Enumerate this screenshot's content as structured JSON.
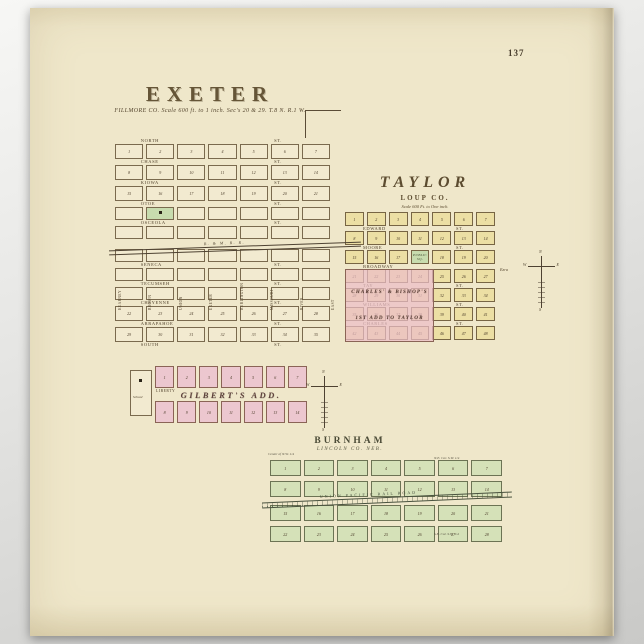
{
  "page": {
    "number": "137"
  },
  "compass": {
    "n": "N",
    "e": "E",
    "s": "S",
    "w": "W"
  },
  "exeter": {
    "title": "EXETER",
    "subtitle": "FILLMORE CO. Scale 600 ft. to 1 inch. Sec's 20 & 29. T.8 N. R.1 W.",
    "railroad": "B. & M. R. R.",
    "school": "School",
    "liberty": "LIBERTY",
    "avenues": [
      "KEARNEY",
      "BROWN",
      "UNION",
      "EXETER",
      "BURLINGTON",
      "MISSOURI",
      "RIVER",
      "EAST"
    ],
    "plat": {
      "rows": [
        {
          "street": {
            "n": "NORTH",
            "s": "ST."
          }
        },
        {
          "kind": "plain",
          "cells": [
            {
              "n": "1"
            },
            {
              "n": "2"
            },
            {
              "n": "3"
            },
            {
              "n": "4"
            },
            {
              "n": "5"
            },
            {
              "n": "6"
            },
            {
              "n": "7"
            }
          ]
        },
        {
          "street": {
            "n": "CHASE",
            "s": "ST."
          }
        },
        {
          "kind": "plain",
          "cells": [
            {
              "n": "8"
            },
            {
              "n": "9"
            },
            {
              "n": "10"
            },
            {
              "n": "11"
            },
            {
              "n": "12"
            },
            {
              "n": "13"
            },
            {
              "n": "14"
            }
          ]
        },
        {
          "street": {
            "n": "KIOWA",
            "s": "ST."
          }
        },
        {
          "kind": "plain",
          "cells": [
            {
              "n": "15"
            },
            {
              "n": "16"
            },
            {
              "n": "17"
            },
            {
              "n": "18"
            },
            {
              "n": "19"
            },
            {
              "n": "20"
            },
            {
              "n": "21"
            }
          ]
        },
        {
          "street": {
            "n": "OTOE",
            "s": "ST."
          }
        },
        {
          "kind": "lot",
          "cells": [
            {},
            {
              "k": "green",
              "sq": true
            },
            {},
            {},
            {},
            {},
            {}
          ]
        },
        {
          "street": {
            "n": "OSCEOLA",
            "s": "ST."
          }
        },
        {
          "kind": "lot",
          "cells": [
            {},
            {},
            {},
            {},
            {},
            {},
            {}
          ]
        },
        {
          "gap": true
        },
        {
          "kind": "lot",
          "cells": [
            {},
            {},
            {},
            {},
            {},
            {},
            {}
          ]
        },
        {
          "street": {
            "n": "SENECA",
            "s": "ST."
          }
        },
        {
          "kind": "lot",
          "cells": [
            {},
            {},
            {},
            {},
            {},
            {},
            {}
          ]
        },
        {
          "street": {
            "n": "TECUMSEH",
            "s": "ST."
          }
        },
        {
          "kind": "lot",
          "cells": [
            {},
            {},
            {},
            {},
            {},
            {},
            {}
          ]
        },
        {
          "street": {
            "n": "CHEYENNE",
            "s": "ST."
          }
        },
        {
          "kind": "plain",
          "cells": [
            {
              "n": "22"
            },
            {
              "n": "23"
            },
            {
              "n": "24"
            },
            {
              "n": "25"
            },
            {
              "n": "26"
            },
            {
              "n": "27"
            },
            {
              "n": "28"
            }
          ]
        },
        {
          "street": {
            "n": "ARRAPAHOE",
            "s": "ST."
          }
        },
        {
          "kind": "plain",
          "cells": [
            {
              "n": "29"
            },
            {
              "n": "30"
            },
            {
              "n": "31"
            },
            {
              "n": "32"
            },
            {
              "n": "33"
            },
            {
              "n": "34"
            },
            {
              "n": "35"
            }
          ]
        },
        {
          "street": {
            "n": "SOUTH",
            "s": "ST."
          }
        }
      ]
    },
    "addition": {
      "rows": [
        {
          "kind": "pink",
          "cells": [
            {
              "n": "1"
            },
            {
              "n": "2"
            },
            {
              "n": "3"
            },
            {
              "n": "4"
            },
            {
              "n": "5"
            },
            {
              "n": "6"
            },
            {
              "n": "7"
            }
          ]
        },
        {
          "label": "GILBERT'S ADD."
        },
        {
          "kind": "pink",
          "cells": [
            {
              "n": "8"
            },
            {
              "n": "9"
            },
            {
              "n": "10"
            },
            {
              "n": "11"
            },
            {
              "n": "12"
            },
            {
              "n": "13"
            },
            {
              "n": "14"
            }
          ]
        }
      ]
    }
  },
  "taylor": {
    "title": "TAYLOR",
    "sub1": "LOUP CO.",
    "sub2": "Scale 600 Ft. to One inch.",
    "ezra": "Ezra",
    "addition": {
      "line1": "CHARLES' & BISHOP'S",
      "line2": "1ST ADD TO TAYLOR"
    },
    "plat": {
      "rows": [
        {
          "kind": "ylot",
          "cells": [
            {
              "n": "1"
            },
            {
              "n": "2"
            },
            {
              "n": "3"
            },
            {
              "n": "4"
            },
            {
              "n": "5"
            },
            {
              "n": "6"
            },
            {
              "n": "7"
            }
          ]
        },
        {
          "street": {
            "n": "EDWARD",
            "s": "ST."
          }
        },
        {
          "kind": "ylot",
          "cells": [
            {
              "n": "8"
            },
            {
              "n": "9"
            },
            {
              "n": "10"
            },
            {
              "n": "11"
            },
            {
              "n": "12"
            },
            {
              "n": "13"
            },
            {
              "n": "14"
            }
          ]
        },
        {
          "street": {
            "n": "MOORE",
            "s": "ST."
          }
        },
        {
          "kind": "ylot",
          "cells": [
            {
              "n": "15"
            },
            {
              "n": "16"
            },
            {
              "n": "17"
            },
            {
              "k": "green",
              "l": "PUBLIC\nSQ."
            },
            {
              "n": "18"
            },
            {
              "n": "19"
            },
            {
              "n": "20"
            }
          ]
        },
        {
          "street": {
            "n": "BROADWAY",
            "s": ""
          }
        },
        {
          "kind": "ylot",
          "cells": [
            {
              "n": "21"
            },
            {
              "n": "22"
            },
            {
              "n": "23"
            },
            {
              "n": "24"
            },
            {
              "n": "25"
            },
            {
              "n": "26"
            },
            {
              "n": "27"
            }
          ]
        },
        {
          "street": {
            "n": "TAY",
            "s": "ST."
          }
        },
        {
          "kind": "ylot",
          "cells": [
            {
              "n": "28"
            },
            {
              "n": "29"
            },
            {
              "n": "30"
            },
            {
              "n": "31"
            },
            {
              "n": "32"
            },
            {
              "n": "33"
            },
            {
              "n": "34"
            }
          ]
        },
        {
          "street": {
            "n": "WILLIAMS",
            "s": "ST."
          }
        },
        {
          "kind": "ylot",
          "cells": [
            {
              "n": "35"
            },
            {
              "n": "36"
            },
            {
              "n": "37"
            },
            {
              "n": "38"
            },
            {
              "n": "39"
            },
            {
              "n": "40"
            },
            {
              "n": "41"
            }
          ]
        },
        {
          "street": {
            "n": "CHARLES",
            "s": "ST."
          }
        },
        {
          "kind": "ylot",
          "cells": [
            {
              "n": "42"
            },
            {
              "n": "43"
            },
            {
              "n": "44"
            },
            {
              "n": "45"
            },
            {
              "n": "46"
            },
            {
              "n": "47"
            },
            {
              "n": "48"
            }
          ]
        }
      ]
    }
  },
  "burnham": {
    "title": "BURNHAM",
    "subtitle": "LINCOLN CO. NEB.",
    "railroad": "UNION PACIFIC RAIL ROAD",
    "notes": {
      "tl": "Center of N.W. 1/4",
      "tr": "N.E. Cor. S.W. 1/4",
      "br": "S.E. Cor. S.W. 1/4"
    },
    "plat": {
      "rows": [
        {
          "kind": "glot",
          "cells": [
            {
              "n": "1"
            },
            {
              "n": "2"
            },
            {
              "n": "3"
            },
            {
              "n": "4"
            },
            {
              "n": "5"
            },
            {
              "n": "6"
            },
            {
              "n": "7"
            }
          ]
        },
        {
          "gap": true
        },
        {
          "kind": "glot",
          "cells": [
            {
              "n": "8"
            },
            {
              "n": "9"
            },
            {
              "n": "10"
            },
            {
              "n": "11"
            },
            {
              "n": "12"
            },
            {
              "n": "13"
            },
            {
              "n": "14"
            }
          ]
        },
        {
          "gap": true,
          "tall": true
        },
        {
          "kind": "glot",
          "cells": [
            {
              "n": "15"
            },
            {
              "n": "16"
            },
            {
              "n": "17"
            },
            {
              "n": "18"
            },
            {
              "n": "19"
            },
            {
              "n": "20"
            },
            {
              "n": "21"
            }
          ]
        },
        {
          "gap": true
        },
        {
          "kind": "glot",
          "cells": [
            {
              "n": "22"
            },
            {
              "n": "23"
            },
            {
              "n": "24"
            },
            {
              "n": "25"
            },
            {
              "n": "26"
            },
            {
              "n": "27"
            },
            {
              "n": "28"
            }
          ]
        }
      ]
    }
  }
}
